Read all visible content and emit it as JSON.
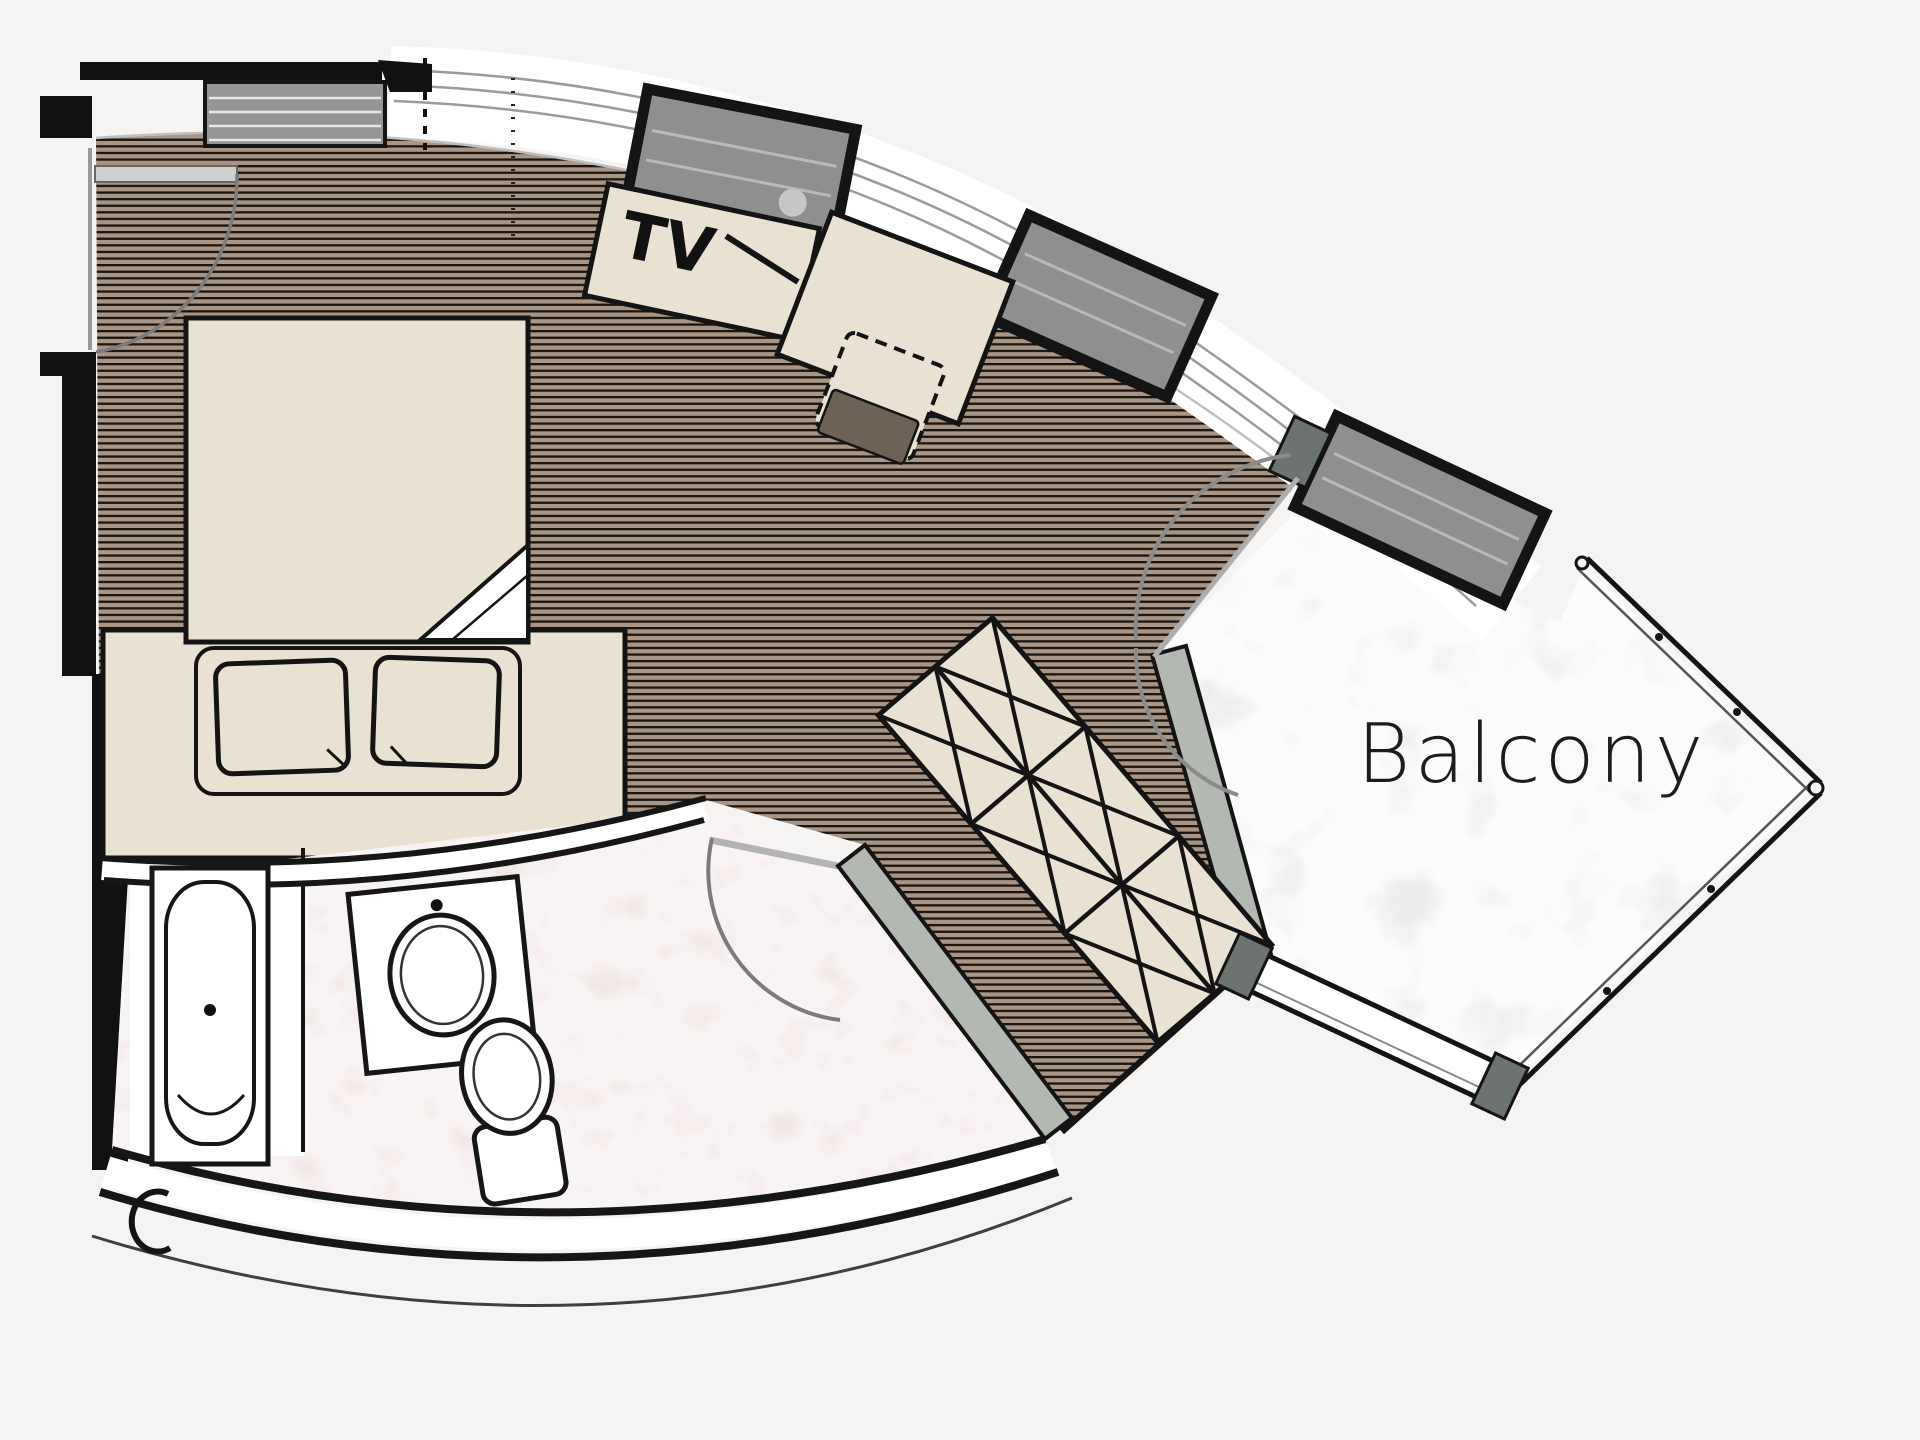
{
  "labels": {
    "tv": "TV",
    "balcony": "Balcony"
  },
  "rooms": [
    {
      "name": "bedroom-living",
      "floor": "wood-strip"
    },
    {
      "name": "bathroom",
      "floor": "pink-marble"
    },
    {
      "name": "balcony",
      "floor": "white-marble"
    }
  ],
  "elements": [
    "double-bed",
    "pillow",
    "pillow",
    "tv-cabinet",
    "desk",
    "desk-chair",
    "wardrobe-x-hatch",
    "bathtub",
    "sink-vanity",
    "toilet",
    "entrance-door",
    "bathroom-door",
    "balcony-double-door",
    "window",
    "window",
    "window",
    "balcony-railing",
    "dresser"
  ],
  "palette": {
    "background": "#f5f4f3",
    "wood_base": "#aa9483",
    "wood_line": "#1a1511",
    "furniture": "#e9e2d3",
    "bath_floor": "#f3e8e8",
    "balcony_floor": "#ededed",
    "window_gray": "#8f8f8f",
    "wall_gray": "#b3b8b3",
    "cap_gray": "#6d736f",
    "seat_brown": "#6e6156",
    "ink": "#141414"
  }
}
